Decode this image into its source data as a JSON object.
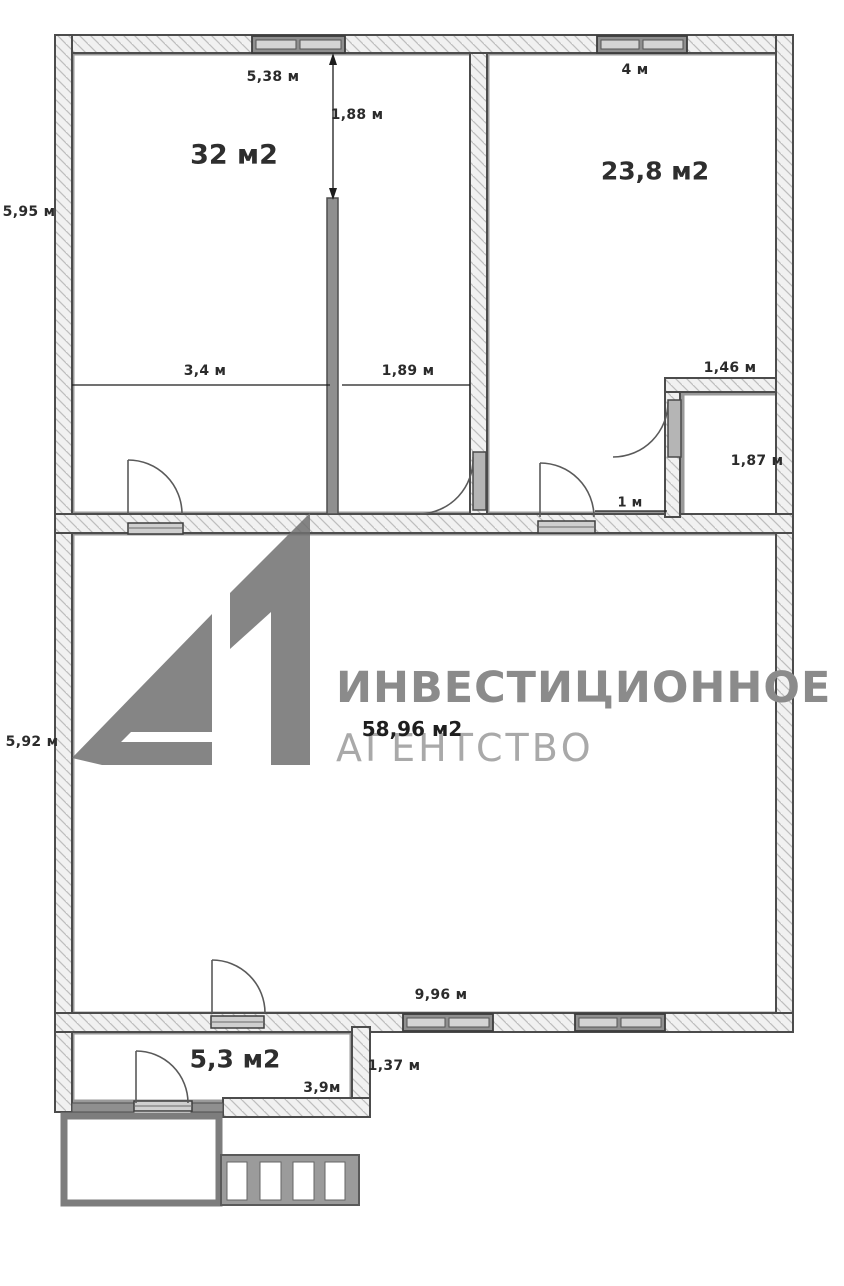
{
  "title": "Floor plan",
  "watermark": {
    "logo_text": "А1",
    "agency_line1": "ИНВЕСТИЦИОННОЕ",
    "agency_line2": "АГЕНТСТВО"
  },
  "rooms": [
    {
      "name": "room-top-left",
      "area": "32 м2"
    },
    {
      "name": "room-top-right",
      "area": "23,8 м2"
    },
    {
      "name": "room-main",
      "area": "58,96 м2"
    },
    {
      "name": "room-entry",
      "area": "5,3 м2"
    }
  ],
  "dimensions": [
    {
      "label": "5,38 м"
    },
    {
      "label": "1,88 м"
    },
    {
      "label": "4 м"
    },
    {
      "label": "5,95 м"
    },
    {
      "label": "3,4 м"
    },
    {
      "label": "1,89 м"
    },
    {
      "label": "1,46 м"
    },
    {
      "label": "1,87 м"
    },
    {
      "label": "1 м"
    },
    {
      "label": "5,92 м"
    },
    {
      "label": "9,96 м"
    },
    {
      "label": "1,37 м"
    },
    {
      "label": "3,9м"
    }
  ],
  "colors": {
    "wall_fill": "#f1f1f1",
    "wall_hatch": "#bdbdbd",
    "wall_outline": "#4c4c4c",
    "inner_outline": "#9a9a9a",
    "window_frame": "#8f8f8f",
    "logo_gray": "#707070",
    "watermark_gray": "#8b8b8b",
    "watermark_light": "#a9a9a9",
    "label_dark": "#2b2b2b"
  }
}
